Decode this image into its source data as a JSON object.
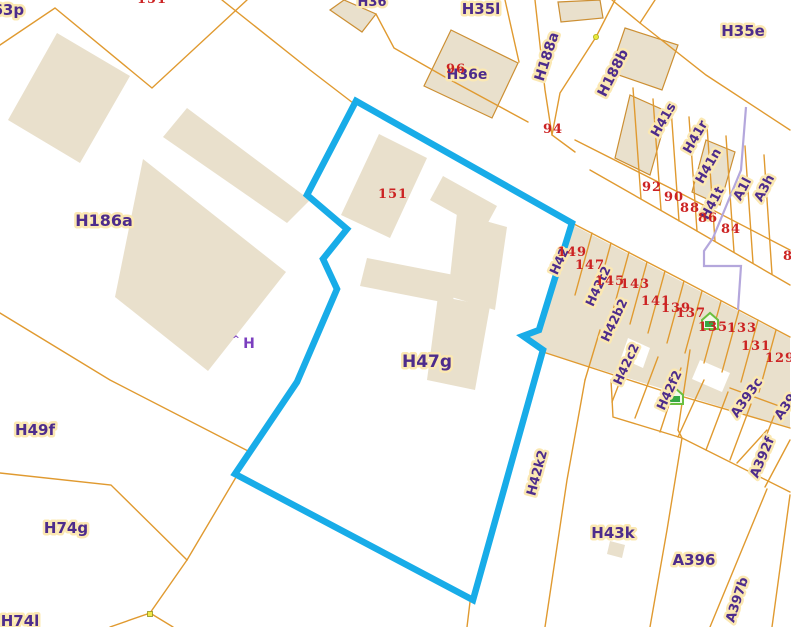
{
  "map": {
    "colors": {
      "background": "#ffffff",
      "building_fill": "#e9e0cc",
      "building_outline": "#cc8f33",
      "parcel_line": "#e09a30",
      "selection_outline": "#18ace8",
      "utility_line": "#b4a7dc",
      "parcel_label_text": "#4d2c8c",
      "parcel_label_halo": "#fbe8b2",
      "house_number_text": "#cc2323",
      "marker_green": "#35a845",
      "marker_yellow": "#f0e846"
    },
    "selected_parcel": {
      "label": "H47g",
      "outline_points": [
        [
          356,
          101
        ],
        [
          572,
          223
        ],
        [
          539,
          330
        ],
        [
          523,
          336
        ],
        [
          543,
          350
        ],
        [
          473,
          600
        ],
        [
          235,
          474
        ],
        [
          297,
          382
        ],
        [
          337,
          289
        ],
        [
          323,
          259
        ],
        [
          347,
          229
        ],
        [
          307,
          195
        ]
      ]
    },
    "parcel_labels": [
      {
        "t": "H63p",
        "x": 2,
        "y": 15,
        "r": 0,
        "s": 15
      },
      {
        "t": "H36",
        "x": 372,
        "y": 6,
        "r": 0,
        "s": 13
      },
      {
        "t": "H35l",
        "x": 481,
        "y": 14,
        "r": 0,
        "s": 15
      },
      {
        "t": "H35e",
        "x": 743,
        "y": 36,
        "r": 0,
        "s": 15
      },
      {
        "t": "H36e",
        "x": 467,
        "y": 79,
        "r": 0,
        "s": 14
      },
      {
        "t": "H188a",
        "x": 551,
        "y": 58,
        "r": -72,
        "s": 14
      },
      {
        "t": "H188b",
        "x": 617,
        "y": 75,
        "r": -63,
        "s": 14
      },
      {
        "t": "H41s",
        "x": 667,
        "y": 122,
        "r": -60,
        "s": 13
      },
      {
        "t": "H41r",
        "x": 699,
        "y": 139,
        "r": -60,
        "s": 13
      },
      {
        "t": "H41n",
        "x": 712,
        "y": 168,
        "r": -60,
        "s": 13
      },
      {
        "t": "H41t",
        "x": 716,
        "y": 205,
        "r": -62,
        "s": 13
      },
      {
        "t": "A1l",
        "x": 746,
        "y": 191,
        "r": -62,
        "s": 13
      },
      {
        "t": "A3h",
        "x": 768,
        "y": 190,
        "r": -62,
        "s": 13
      },
      {
        "t": "H186a",
        "x": 104,
        "y": 226,
        "r": 0,
        "s": 16
      },
      {
        "t": "H42",
        "x": 563,
        "y": 263,
        "r": -65,
        "s": 12.5
      },
      {
        "t": "H42t2",
        "x": 602,
        "y": 288,
        "r": -65,
        "s": 12.5
      },
      {
        "t": "H42b2",
        "x": 618,
        "y": 322,
        "r": -65,
        "s": 12.5
      },
      {
        "t": "H42c2",
        "x": 630,
        "y": 366,
        "r": -65,
        "s": 12.5
      },
      {
        "t": "H42f2",
        "x": 673,
        "y": 392,
        "r": -65,
        "s": 12.5
      },
      {
        "t": "H42k2",
        "x": 541,
        "y": 474,
        "r": -75,
        "s": 13
      },
      {
        "t": "A393c",
        "x": 750,
        "y": 400,
        "r": -55,
        "s": 13
      },
      {
        "t": "A39",
        "x": 789,
        "y": 409,
        "r": -55,
        "s": 13
      },
      {
        "t": "A392f",
        "x": 766,
        "y": 459,
        "r": -67,
        "s": 13
      },
      {
        "t": "A397b",
        "x": 741,
        "y": 601,
        "r": -72,
        "s": 13
      },
      {
        "t": "H47g",
        "x": 427,
        "y": 367,
        "r": 0,
        "s": 17
      },
      {
        "t": "H43k",
        "x": 613,
        "y": 538,
        "r": 0,
        "s": 15
      },
      {
        "t": "A396",
        "x": 694,
        "y": 565,
        "r": 0,
        "s": 15
      },
      {
        "t": "H49f",
        "x": 35,
        "y": 435,
        "r": 0,
        "s": 15
      },
      {
        "t": "H74g",
        "x": 66,
        "y": 533,
        "r": 0,
        "s": 15
      },
      {
        "t": "H74l",
        "x": 20,
        "y": 626,
        "r": 0,
        "s": 15
      }
    ],
    "house_numbers": [
      {
        "t": "151",
        "x": 152,
        "y": 3
      },
      {
        "t": "96",
        "x": 456,
        "y": 73
      },
      {
        "t": "94",
        "x": 553,
        "y": 133
      },
      {
        "t": "92",
        "x": 652,
        "y": 191
      },
      {
        "t": "90",
        "x": 674,
        "y": 201
      },
      {
        "t": "88",
        "x": 690,
        "y": 212
      },
      {
        "t": "86",
        "x": 708,
        "y": 222
      },
      {
        "t": "84",
        "x": 731,
        "y": 233
      },
      {
        "t": "82",
        "x": 793,
        "y": 260
      },
      {
        "t": "151",
        "x": 393,
        "y": 198
      },
      {
        "t": "149",
        "x": 572,
        "y": 256
      },
      {
        "t": "147",
        "x": 590,
        "y": 269
      },
      {
        "t": "145",
        "x": 610,
        "y": 285
      },
      {
        "t": "143",
        "x": 635,
        "y": 288
      },
      {
        "t": "141",
        "x": 656,
        "y": 305
      },
      {
        "t": "139",
        "x": 676,
        "y": 312
      },
      {
        "t": "137",
        "x": 691,
        "y": 317
      },
      {
        "t": "135",
        "x": 713,
        "y": 331
      },
      {
        "t": "133",
        "x": 742,
        "y": 332
      },
      {
        "t": "131",
        "x": 756,
        "y": 350
      },
      {
        "t": "129",
        "x": 780,
        "y": 362
      }
    ],
    "annotation_labels": [
      {
        "t": "H",
        "x": 249,
        "y": 348,
        "s": 14
      },
      {
        "t": "^",
        "x": 236,
        "y": 342,
        "s": 9
      }
    ],
    "buildings": [
      {
        "pts": [
          [
            57,
            33
          ],
          [
            130,
            76
          ],
          [
            80,
            163
          ],
          [
            8,
            120
          ]
        ],
        "o": 0
      },
      {
        "pts": [
          [
            163,
            137
          ],
          [
            187,
            108
          ],
          [
            310,
            200
          ],
          [
            287,
            223
          ]
        ],
        "o": 0
      },
      {
        "pts": [
          [
            143,
            159
          ],
          [
            286,
            272
          ],
          [
            208,
            371
          ],
          [
            115,
            297
          ]
        ],
        "o": 0
      },
      {
        "pts": [
          [
            379,
            134
          ],
          [
            427,
            158
          ],
          [
            390,
            238
          ],
          [
            341,
            215
          ]
        ],
        "o": 0
      },
      {
        "pts": [
          [
            443,
            176
          ],
          [
            497,
            206
          ],
          [
            484,
            230
          ],
          [
            430,
            200
          ]
        ],
        "o": 0
      },
      {
        "pts": [
          [
            457,
            213
          ],
          [
            507,
            227
          ],
          [
            495,
            310
          ],
          [
            448,
            296
          ]
        ],
        "o": 0
      },
      {
        "pts": [
          [
            367,
            258
          ],
          [
            459,
            276
          ],
          [
            452,
            304
          ],
          [
            360,
            286
          ]
        ],
        "o": 0
      },
      {
        "pts": [
          [
            438,
            296
          ],
          [
            490,
            306
          ],
          [
            475,
            390
          ],
          [
            427,
            380
          ]
        ],
        "o": 0
      },
      {
        "pts": [
          [
            573,
            225
          ],
          [
            790,
            338
          ],
          [
            790,
            428
          ],
          [
            543,
            352
          ],
          [
            523,
            337
          ],
          [
            539,
            331
          ]
        ],
        "o": 0
      },
      {
        "pts": [
          [
            628,
            338
          ],
          [
            650,
            348
          ],
          [
            643,
            368
          ],
          [
            621,
            358
          ]
        ],
        "o": 0,
        "w": 1
      },
      {
        "pts": [
          [
            700,
            360
          ],
          [
            730,
            373
          ],
          [
            722,
            392
          ],
          [
            692,
            379
          ]
        ],
        "o": 0,
        "w": 1
      },
      {
        "pts": [
          [
            451,
            30
          ],
          [
            518,
            63
          ],
          [
            492,
            118
          ],
          [
            424,
            86
          ]
        ],
        "o": 1
      },
      {
        "pts": [
          [
            330,
            10
          ],
          [
            344,
            0
          ],
          [
            376,
            14
          ],
          [
            362,
            32
          ]
        ],
        "o": 1
      },
      {
        "pts": [
          [
            558,
            2
          ],
          [
            600,
            0
          ],
          [
            603,
            18
          ],
          [
            561,
            22
          ]
        ],
        "o": 1
      },
      {
        "pts": [
          [
            625,
            28
          ],
          [
            678,
            45
          ],
          [
            662,
            90
          ],
          [
            610,
            72
          ]
        ],
        "o": 1
      },
      {
        "pts": [
          [
            630,
            95
          ],
          [
            668,
            112
          ],
          [
            650,
            175
          ],
          [
            615,
            158
          ]
        ],
        "o": 1
      },
      {
        "pts": [
          [
            706,
            140
          ],
          [
            735,
            152
          ],
          [
            720,
            205
          ],
          [
            692,
            192
          ]
        ],
        "o": 1
      },
      {
        "pts": [
          [
            610,
            541
          ],
          [
            625,
            545
          ],
          [
            622,
            558
          ],
          [
            607,
            554
          ]
        ],
        "o": 0
      }
    ],
    "parcel_lines": [
      [
        [
          0,
          45
        ],
        [
          55,
          8
        ],
        [
          152,
          88
        ],
        [
          247,
          0
        ]
      ],
      [
        [
          222,
          0
        ],
        [
          310,
          70
        ],
        [
          353,
          103
        ]
      ],
      [
        [
          376,
          14
        ],
        [
          394,
          48
        ],
        [
          445,
          77
        ],
        [
          528,
          122
        ]
      ],
      [
        [
          505,
          0
        ],
        [
          519,
          62
        ]
      ],
      [
        [
          612,
          0
        ],
        [
          640,
          23
        ],
        [
          655,
          0
        ]
      ],
      [
        [
          640,
          23
        ],
        [
          706,
          75
        ],
        [
          790,
          130
        ]
      ],
      [
        [
          535,
          0
        ],
        [
          545,
          90
        ],
        [
          552,
          135
        ],
        [
          575,
          152
        ]
      ],
      [
        [
          615,
          0
        ],
        [
          596,
          37
        ],
        [
          560,
          93
        ],
        [
          552,
          135
        ]
      ],
      [
        [
          575,
          140
        ],
        [
          680,
          193
        ],
        [
          790,
          250
        ]
      ],
      [
        [
          590,
          170
        ],
        [
          690,
          227
        ],
        [
          790,
          285
        ]
      ],
      [
        [
          572,
          223
        ],
        [
          680,
          279
        ],
        [
          790,
          337
        ]
      ],
      [
        [
          543,
          352
        ],
        [
          660,
          390
        ],
        [
          790,
          428
        ]
      ],
      [
        [
          633,
          88
        ],
        [
          641,
          199
        ]
      ],
      [
        [
          653,
          99
        ],
        [
          661,
          210
        ]
      ],
      [
        [
          671,
          108
        ],
        [
          679,
          221
        ]
      ],
      [
        [
          689,
          117
        ],
        [
          697,
          231
        ]
      ],
      [
        [
          707,
          126
        ],
        [
          715,
          241
        ]
      ],
      [
        [
          726,
          136
        ],
        [
          734,
          252
        ]
      ],
      [
        [
          745,
          146
        ],
        [
          753,
          263
        ]
      ],
      [
        [
          764,
          155
        ],
        [
          772,
          274
        ]
      ],
      [
        [
          592,
          233
        ],
        [
          575,
          295
        ]
      ],
      [
        [
          611,
          243
        ],
        [
          594,
          305
        ]
      ],
      [
        [
          629,
          252
        ],
        [
          612,
          314
        ]
      ],
      [
        [
          647,
          262
        ],
        [
          630,
          324
        ]
      ],
      [
        [
          665,
          271
        ],
        [
          648,
          333
        ]
      ],
      [
        [
          684,
          281
        ],
        [
          667,
          343
        ]
      ],
      [
        [
          702,
          291
        ],
        [
          685,
          353
        ]
      ],
      [
        [
          721,
          301
        ],
        [
          704,
          363
        ]
      ],
      [
        [
          739,
          310
        ],
        [
          722,
          372
        ]
      ],
      [
        [
          758,
          320
        ],
        [
          741,
          382
        ]
      ],
      [
        [
          776,
          330
        ],
        [
          759,
          392
        ]
      ],
      [
        [
          600,
          330
        ],
        [
          585,
          380
        ]
      ],
      [
        [
          634,
          345
        ],
        [
          612,
          402
        ]
      ],
      [
        [
          658,
          357
        ],
        [
          635,
          418
        ]
      ],
      [
        [
          681,
          368
        ],
        [
          660,
          432
        ]
      ],
      [
        [
          704,
          380
        ],
        [
          678,
          437
        ]
      ],
      [
        [
          728,
          392
        ],
        [
          706,
          450
        ]
      ],
      [
        [
          751,
          404
        ],
        [
          730,
          460
        ]
      ],
      [
        [
          774,
          416
        ],
        [
          752,
          472
        ]
      ],
      [
        [
          585,
          380
        ],
        [
          567,
          480
        ],
        [
          545,
          627
        ]
      ],
      [
        [
          611,
          380
        ],
        [
          613,
          417
        ],
        [
          682,
          438
        ]
      ],
      [
        [
          682,
          438
        ],
        [
          667,
          530
        ],
        [
          650,
          627
        ]
      ],
      [
        [
          678,
          430
        ],
        [
          682,
          438
        ],
        [
          790,
          492
        ]
      ],
      [
        [
          737,
          463
        ],
        [
          767,
          430
        ]
      ],
      [
        [
          765,
          487
        ],
        [
          790,
          440
        ]
      ],
      [
        [
          730,
          388
        ],
        [
          790,
          410
        ]
      ],
      [
        [
          790,
          495
        ],
        [
          772,
          627
        ]
      ],
      [
        [
          767,
          489
        ],
        [
          710,
          627
        ]
      ],
      [
        [
          690,
          350
        ],
        [
          678,
          430
        ]
      ],
      [
        [
          470,
          602
        ],
        [
          467,
          627
        ]
      ],
      [
        [
          0,
          313
        ],
        [
          110,
          380
        ],
        [
          250,
          452
        ]
      ],
      [
        [
          0,
          473
        ],
        [
          111,
          485
        ],
        [
          187,
          560
        ]
      ],
      [
        [
          187,
          560
        ],
        [
          245,
          462
        ]
      ],
      [
        [
          187,
          560
        ],
        [
          150,
          613
        ],
        [
          110,
          627
        ]
      ],
      [
        [
          150,
          613
        ],
        [
          173,
          627
        ]
      ]
    ],
    "utility_line": [
      [
        746,
        107
      ],
      [
        741,
        170
      ],
      [
        713,
        238
      ],
      [
        704,
        251
      ],
      [
        704,
        266
      ],
      [
        741,
        266
      ],
      [
        738,
        310
      ]
    ],
    "markers": {
      "green_houses": [
        [
          710,
          322
        ],
        [
          675,
          397
        ]
      ],
      "yellow_dot": [
        596,
        37
      ],
      "yellow_square": [
        150,
        614
      ]
    }
  }
}
